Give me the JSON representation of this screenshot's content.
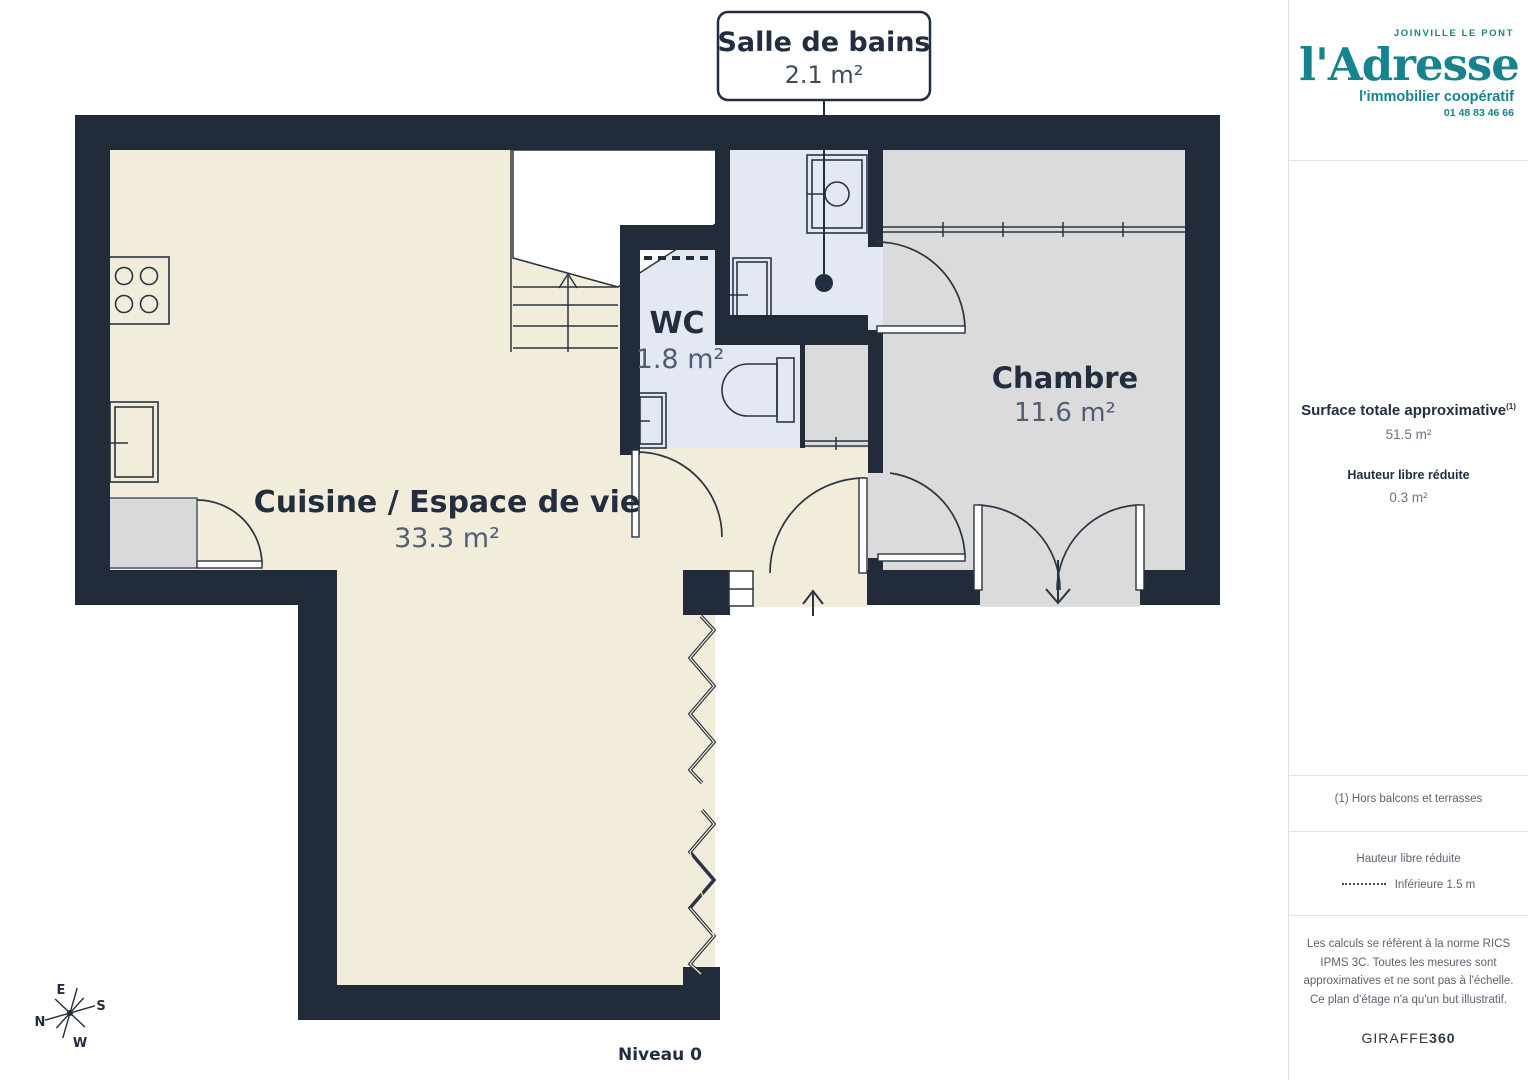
{
  "plan": {
    "level_label": "Niveau 0",
    "callout": {
      "title": "Salle de bains",
      "area": "2.1 m²"
    },
    "rooms": [
      {
        "name": "WC",
        "area": "1.8 m²"
      },
      {
        "name": "Chambre",
        "area": "11.6 m²"
      },
      {
        "name": "Cuisine / Espace de vie",
        "area": "33.3 m²"
      }
    ],
    "compass": {
      "n": "N",
      "s": "S",
      "e": "E",
      "w": "W"
    }
  },
  "sidebar": {
    "agency": {
      "location": "JOINVILLE LE PONT",
      "name": "l'Adresse",
      "tagline": "l'immobilier coopératif",
      "phone": "01 48 83 46 66",
      "brand_color": "#17838e"
    },
    "surface": {
      "title": "Surface totale approximative",
      "title_superscript": "(1)",
      "value": "51.5 m²"
    },
    "reduced_height": {
      "title": "Hauteur libre réduite",
      "value": "0.3 m²"
    },
    "footnote": "(1) Hors balcons et terrasses",
    "legend": {
      "title": "Hauteur libre réduite",
      "item": "Inférieure 1.5 m"
    },
    "disclaimer": "Les calculs se réfèrent à la norme RICS IPMS 3C. Toutes les mesures sont approximatives et ne sont pas à l'échelle. Ce plan d'étage n'a qu'un but illustratif.",
    "brand_footer": {
      "name": "GIRAFFE",
      "suffix": "360"
    }
  },
  "colors": {
    "wall": "#212b3a",
    "floor_living": "#f2ecda",
    "floor_bedroom": "#dbdbdb",
    "floor_wet": "#e4e8f2",
    "brand_teal": "#17838e",
    "label_dark": "#222e3f",
    "label_gray": "#515d73"
  }
}
